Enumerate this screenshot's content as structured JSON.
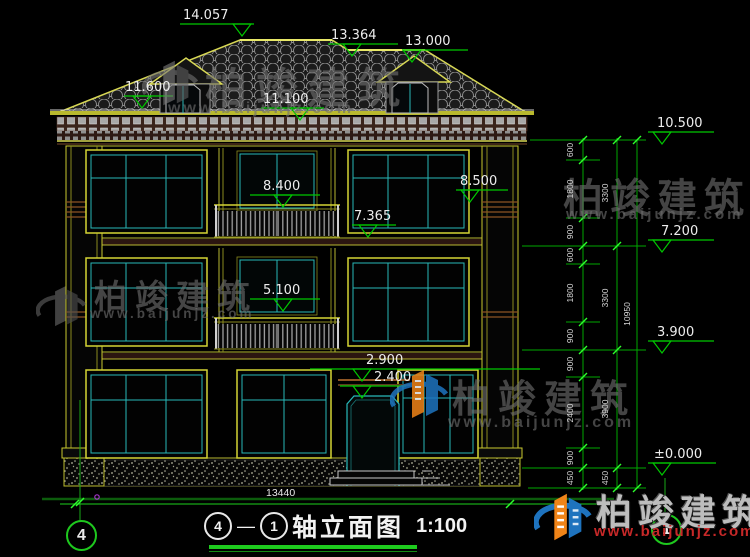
{
  "drawing": {
    "title": {
      "axis_left": "4",
      "dash": "—",
      "axis_right": "1",
      "text": "轴立面图",
      "scale": "1:100"
    },
    "axis_bubbles": {
      "left": "4",
      "right": "1"
    },
    "elevation_marks": {
      "ridge": "14.057",
      "ridge2": "13.364",
      "dormer": "13.000",
      "eave_left": "11.600",
      "eave_main": "11.100",
      "balcony_f3": "8.400",
      "slab_f3": "7.365",
      "balcony_f2": "5.100",
      "canopy_top": "2.900",
      "canopy_bottom": "2.400",
      "porch": "8.500",
      "right_eave": "10.500",
      "right_slab3": "7.200",
      "right_slab2": "3.900",
      "right_ground": "±0.000"
    },
    "dimensions": {
      "detail_chain": [
        "600",
        "1800",
        "900",
        "600",
        "1800",
        "900",
        "900",
        "2400",
        "900",
        "450"
      ],
      "floor_chain": [
        "3300",
        "3300",
        "3900",
        "450"
      ],
      "total_height": "10950",
      "total_width": "13440"
    }
  },
  "watermark": {
    "brand": "柏竣建筑",
    "url": "www.baijunjz.com"
  },
  "logo": {
    "brand": "柏竣建筑",
    "url": "www.baijunjz.com"
  },
  "colors": {
    "dimension_green": "#00b000",
    "tick_green": "#2dff2d",
    "frame_yellow": "#d4d434",
    "mullion_cyan": "#28b8b8",
    "brand_orange": "#f08418",
    "brand_blue": "#1e73be",
    "url_red": "#c62828"
  }
}
